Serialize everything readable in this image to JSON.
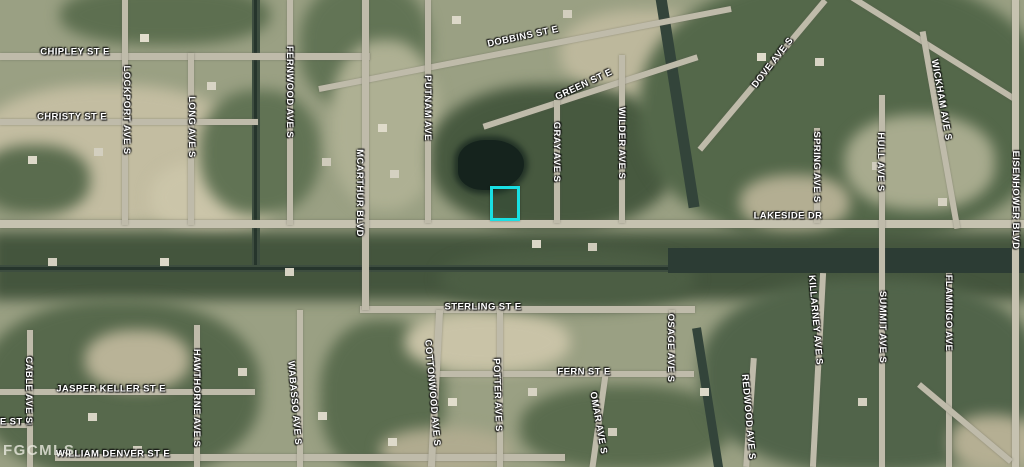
{
  "map": {
    "type": "satellite-parcel-map",
    "watermark": "FGCMLS",
    "highlight_color": "#19dfe3",
    "streets": {
      "chipley": "CHIPLEY ST E",
      "christy": "CHRISTY ST E",
      "lockport": "LOCKPORT AVE S",
      "long": "LONG AVE S",
      "fernwood": "FERNWOOD AVE S",
      "mcarthur": "MCARTHUR BLVD",
      "putnam": "PUTNAM AVE",
      "dobbins": "DOBBINS ST E",
      "green": "GREEN ST E",
      "gray": "GRAY AVE S",
      "wilder": "WILDER AVE S",
      "dove": "DOVE AVE S",
      "wickham": "WICKHAM AVE S",
      "spring": "SPRING AVE S",
      "hull": "HULL AVE S",
      "eisenhower": "EISENHOWER BLVD",
      "lakeside": "LAKESIDE DR",
      "sterling": "STERLING ST E",
      "fern": "FERN ST E",
      "jasper_keller": "JASPER KELLER ST E",
      "william_denver": "WILLIAM DENVER ST E",
      "le_partial": "LE ST E",
      "cable": "CABLE AVE S",
      "hawthorne": "HAWTHORNE AVE S",
      "wabasso": "WABASSO AVE S",
      "cottonwood": "COTTONWOOD AVE S",
      "potter": "POTTER AVE S",
      "omar": "OMAR AVE S",
      "osage": "OSAGE AVE S",
      "killarney": "KILLARNEY AVE S",
      "summit": "SUMMIT AVE S",
      "redwood": "REDWOOD AVE S",
      "flamingo": "FLAMINGO AVE"
    }
  }
}
